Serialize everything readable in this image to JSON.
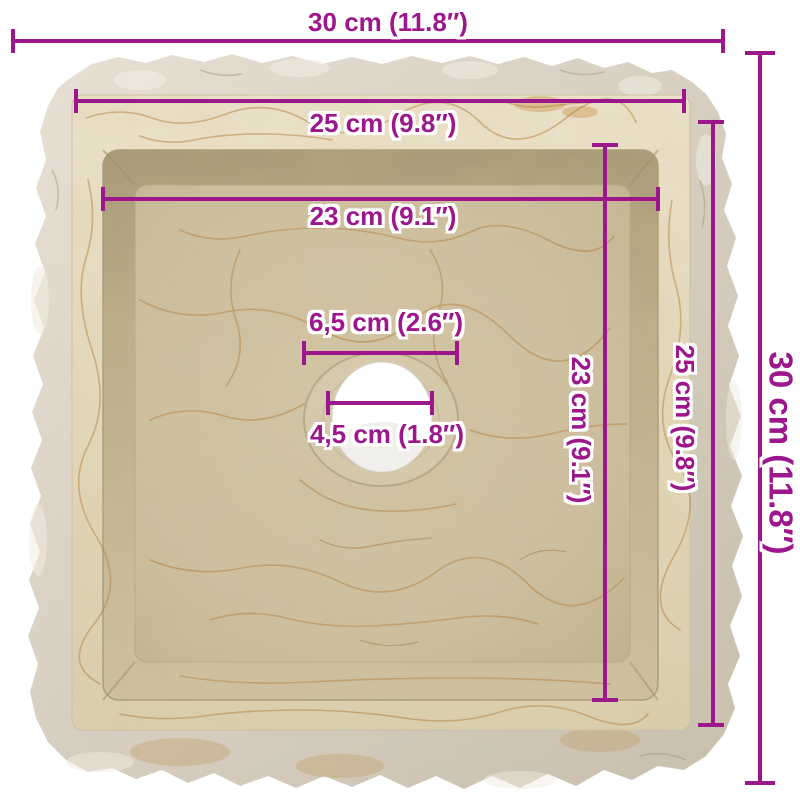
{
  "image": {
    "subject": "cream-marble-square-sink-top-view-dimension-diagram",
    "background": "#ffffff"
  },
  "colors": {
    "accent": "#9c168c",
    "marble_rock": "#d8d0c3",
    "marble_rim": "#e7dcc2",
    "marble_floor": "#cdbf9f",
    "marble_vein": "#b47c3c",
    "drain_hole": "#ffffff"
  },
  "dimensions": {
    "overall_width": {
      "label": "30 cm (11.8″)",
      "cm": 30,
      "inches": 11.8
    },
    "rim_width": {
      "label": "25 cm (9.8″)",
      "cm": 25,
      "inches": 9.8
    },
    "basin_width": {
      "label": "23 cm (9.1″)",
      "cm": 23,
      "inches": 9.1
    },
    "drain_recess_diameter": {
      "label": "6,5 cm (2.6″)",
      "cm": 6.5,
      "inches": 2.6
    },
    "drain_hole_diameter": {
      "label": "4,5 cm (1.8″)",
      "cm": 4.5,
      "inches": 1.8
    },
    "basin_depth": {
      "label": "23 cm (9.1″)",
      "cm": 23,
      "inches": 9.1
    },
    "rim_depth": {
      "label": "25 cm (9.8″)",
      "cm": 25,
      "inches": 9.8
    },
    "overall_depth": {
      "label": "30 cm (11.8″)",
      "cm": 30,
      "inches": 11.8
    }
  }
}
